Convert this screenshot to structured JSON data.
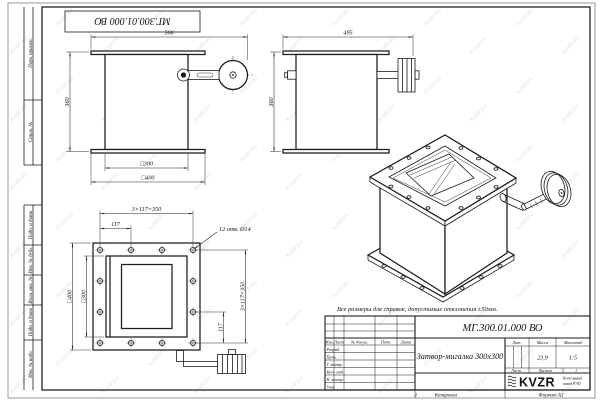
{
  "watermark": {
    "text": "KVZR.RU",
    "color": "#b9c5cf"
  },
  "corner_stamp": {
    "doc_number": "МГ.300.01.000 ВО"
  },
  "margin_fields": {
    "perv": "Перв. примен.",
    "sprav": "Справ. №",
    "podp1": "Подп. и дата",
    "inv_dubl": "Инв. № дубл.",
    "vzam": "Взам. инв. №",
    "podp2": "Подп. и дата",
    "inv_podl": "Инв. № подл."
  },
  "front_view": {
    "dim_width": "566",
    "dim_height": "360",
    "dim_inner": "□300",
    "dim_outer": "□400"
  },
  "side_view": {
    "dim_width": "495",
    "dim_height": "360"
  },
  "flange_view": {
    "dim_pitch_h": "3×117=350",
    "dim_step_h": "117",
    "holes_note": "12 отв. Ø14",
    "dim_outer": "□400",
    "dim_inner": "□300",
    "dim_pitch_v": "3×117=350",
    "dim_step_v": "117"
  },
  "note": "Все размеры для справок, допустимые отклонения ±50мм.",
  "title_block": {
    "doc_number": "МГ.300.01.000 ВО",
    "name": "Затвор-мигалка 300х300",
    "cols": {
      "izm": "Изм.",
      "list": "Лист",
      "doc": "№ докум.",
      "podp": "Подп.",
      "data": "Дата"
    },
    "rows": [
      "Разраб.",
      "Пров.",
      "Т. контр.",
      "Нач. отд.",
      "Н. контр.",
      "Утв."
    ],
    "lit": "Лит.",
    "mass": "Масса",
    "scale": "Масштаб",
    "mass_value": "23,9",
    "scale_value": "1:5",
    "sheet": "Лист",
    "sheets": "Листов",
    "sheets_value": "1",
    "logo": "KVZR",
    "company1": "Котельный",
    "company2": "завод РЭП"
  },
  "footer": {
    "mark": "1",
    "copied": "Копировал",
    "format": "Формат А3"
  }
}
